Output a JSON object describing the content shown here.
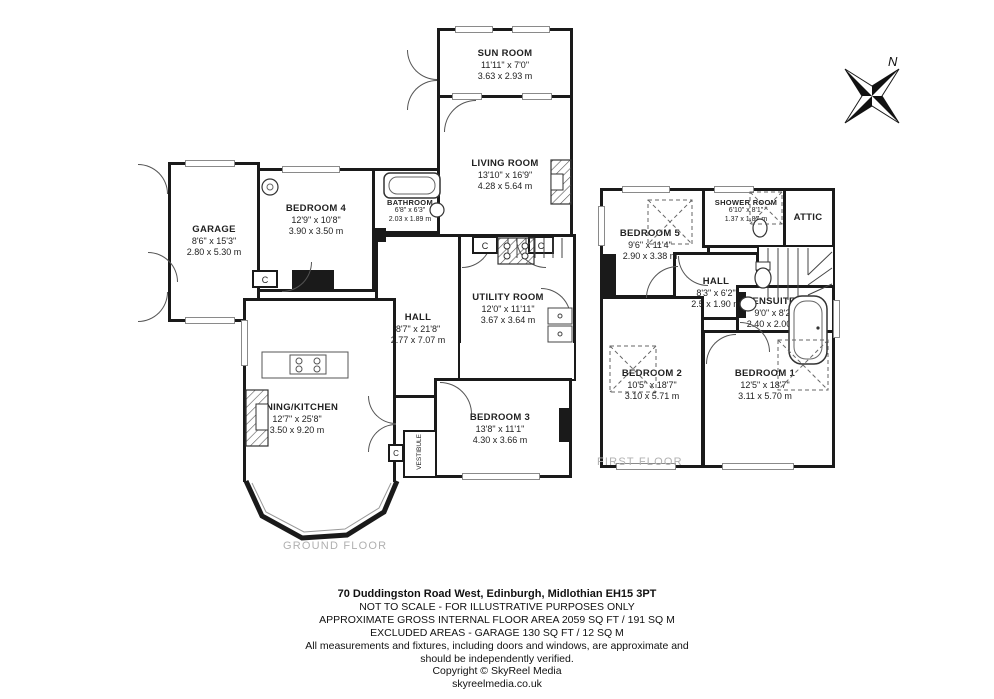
{
  "labels": {
    "cupboard": "C"
  },
  "compass": {
    "label": "N"
  },
  "ground_floor": {
    "label": "GROUND FLOOR",
    "rooms": [
      {
        "name": "SUN ROOM",
        "dims_ft": "11'11\" x 7'0\"",
        "dims_m": "3.63 x 2.93 m"
      },
      {
        "name": "LIVING ROOM",
        "dims_ft": "13'10\" x 16'9\"",
        "dims_m": "4.28 x 5.64 m"
      },
      {
        "name": "BATHROOM",
        "dims_ft": "6'8\" x 6'3\"",
        "dims_m": "2.03 x 1.89 m"
      },
      {
        "name": "BEDROOM 4",
        "dims_ft": "12'9\" x 10'8\"",
        "dims_m": "3.90 x 3.50 m"
      },
      {
        "name": "GARAGE",
        "dims_ft": "8'6\" x 15'3\"",
        "dims_m": "2.80 x 5.30 m"
      },
      {
        "name": "HALL",
        "dims_ft": "8'7\" x 21'8\"",
        "dims_m": "2.77 x 7.07 m"
      },
      {
        "name": "UTILITY ROOM",
        "dims_ft": "12'0\" x 11'11\"",
        "dims_m": "3.67 x 3.64 m"
      },
      {
        "name": "DINING/KITCHEN",
        "dims_ft": "12'7\" x 25'8\"",
        "dims_m": "3.50 x 9.20 m"
      },
      {
        "name": "BEDROOM 3",
        "dims_ft": "13'8\" x 11'1\"",
        "dims_m": "4.30 x 3.66 m"
      },
      {
        "name": "VESTIBULE",
        "dims_ft": "",
        "dims_m": ""
      }
    ]
  },
  "first_floor": {
    "label": "FIRST FLOOR",
    "rooms": [
      {
        "name": "BEDROOM 5",
        "dims_ft": "9'6\" x 11'4\"",
        "dims_m": "2.90 x 3.38 m"
      },
      {
        "name": "SHOWER ROOM",
        "dims_ft": "6'10\" x 8'1\"",
        "dims_m": "1.37 x 1.87 m"
      },
      {
        "name": "ATTIC",
        "dims_ft": "",
        "dims_m": ""
      },
      {
        "name": "HALL",
        "dims_ft": "8'3\" x 6'2\"",
        "dims_m": "2.5 x 1.90 m"
      },
      {
        "name": "ENSUITE",
        "dims_ft": "9'0\" x 8'2\"",
        "dims_m": "2.40 x 2.00 m"
      },
      {
        "name": "BEDROOM 2",
        "dims_ft": "10'5\" x 18'7\"",
        "dims_m": "3.10 x 5.71 m"
      },
      {
        "name": "BEDROOM 1",
        "dims_ft": "12'5\" x 18'7\"",
        "dims_m": "3.11 x 5.70 m"
      }
    ]
  },
  "footer": {
    "address": "70 Duddingston Road West, Edinburgh, Midlothian EH15 3PT",
    "lines": [
      "NOT TO SCALE - FOR ILLUSTRATIVE PURPOSES ONLY",
      "APPROXIMATE GROSS INTERNAL FLOOR AREA 2059 SQ FT / 191 SQ M",
      "EXCLUDED AREAS - GARAGE 130 SQ FT / 12 SQ M",
      "All measurements and fixtures, including doors and windows, are approximate and",
      "should be independently verified.",
      "Copyright © SkyReel Media",
      "skyreelmedia.co.uk"
    ]
  }
}
